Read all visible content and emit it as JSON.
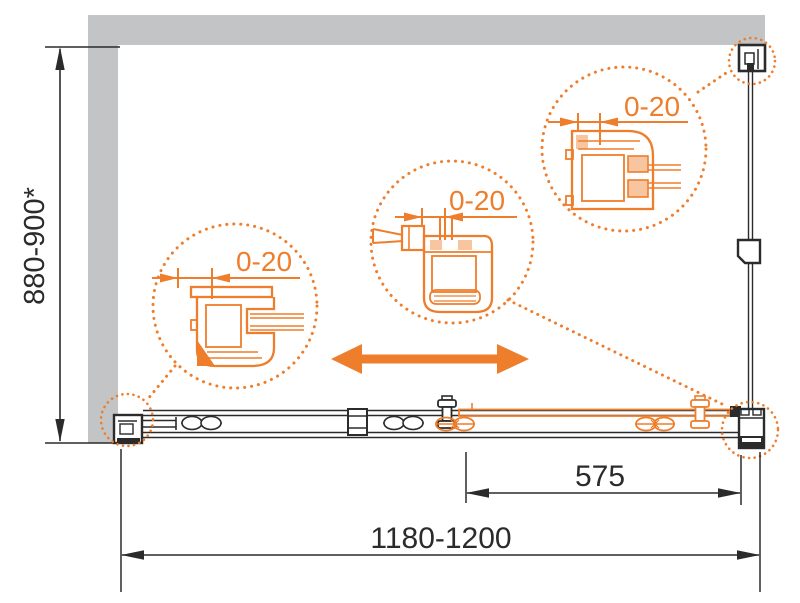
{
  "drawing": {
    "title": "shower-enclosure-installation-diagram",
    "colors": {
      "accent_orange": "#EE7E2B",
      "wall_gray": "#C2C4C6",
      "line_black": "#2B2B2B"
    },
    "dimension_labels": {
      "height": "880-900*",
      "total_width": "1180-1200",
      "door_width": "575"
    },
    "detail_callouts": [
      {
        "id": "wall-profile-detail-left",
        "adjustment": "0-20"
      },
      {
        "id": "wall-profile-detail-middle",
        "adjustment": "0-20"
      },
      {
        "id": "wall-profile-detail-top-right",
        "adjustment": "0-20"
      }
    ]
  }
}
